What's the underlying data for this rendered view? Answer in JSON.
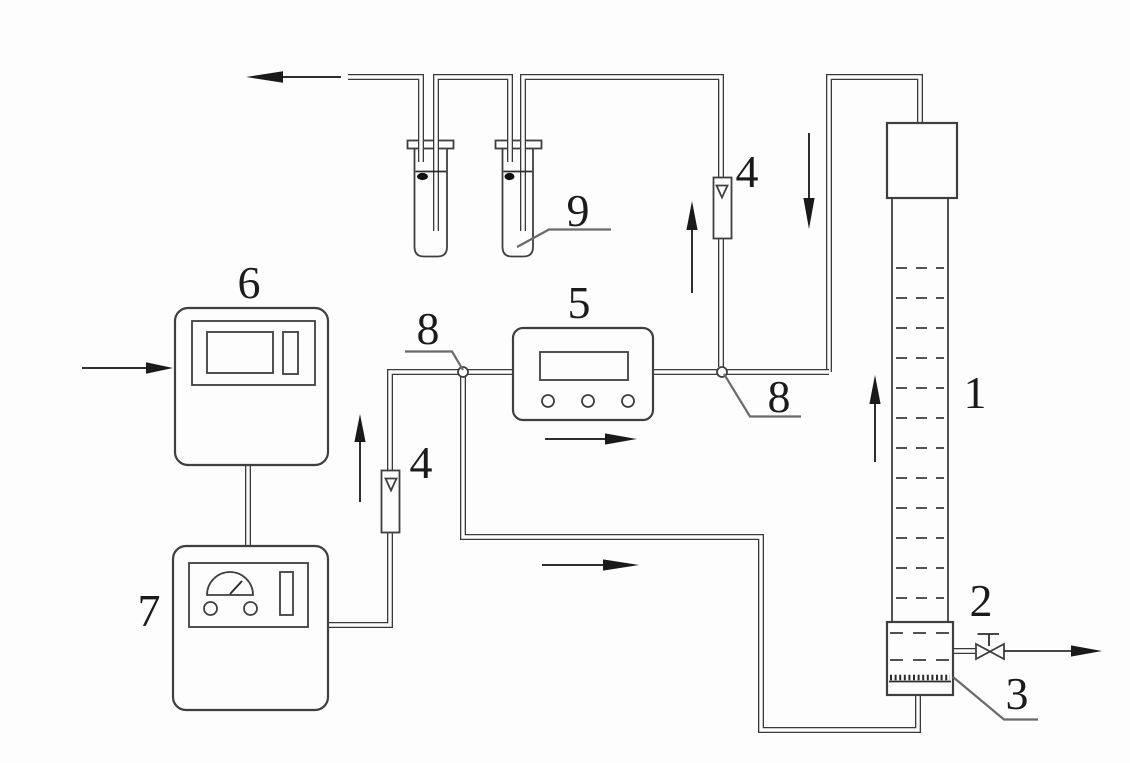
{
  "diagram": {
    "type": "process-flow-schematic",
    "labels": {
      "column": "1",
      "column_base": "2",
      "gas_distributor": "3",
      "flowmeter_left": "4",
      "flowmeter_right": "4",
      "meter_unit": "5",
      "controller_unit": "6",
      "power_unit": "7",
      "junction_left": "8",
      "junction_right": "8",
      "absorber_bottle": "9"
    },
    "colors": {
      "line": "#3a3a3a",
      "background": "#fdfdfd",
      "label_text": "#1b1b1b"
    }
  }
}
